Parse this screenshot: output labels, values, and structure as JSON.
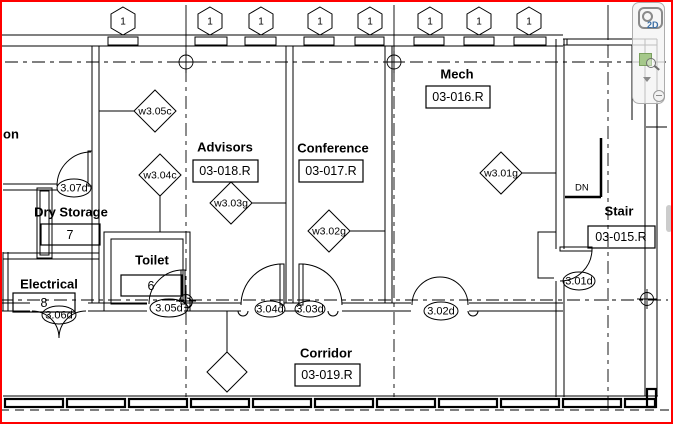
{
  "colors": {
    "selection_border": "#ff0000",
    "drawing_line": "#000000",
    "background": "#ffffff",
    "nav_2d_label_blue": "#3a6ea5",
    "nav_zoom_green": "#a5c88a",
    "nav_icon_gray": "#8a8a8a",
    "scrollbar_thumb": "#cccccc"
  },
  "grid_bubbles": [
    "1",
    "1",
    "1",
    "1",
    "1",
    "1",
    "1",
    "1"
  ],
  "rooms": {
    "partial_left": {
      "name": "on"
    },
    "dry_storage": {
      "name": "Dry Storage",
      "number": "7"
    },
    "toilet": {
      "name": "Toilet",
      "number": "6"
    },
    "electrical": {
      "name": "Electrical",
      "number": "8"
    },
    "advisors": {
      "name": "Advisors",
      "number": "03-018.R"
    },
    "conference": {
      "name": "Conference",
      "number": "03-017.R"
    },
    "mech": {
      "name": "Mech",
      "number": "03-016.R"
    },
    "stair": {
      "name": "Stair",
      "number": "03-015.R"
    },
    "corridor": {
      "name": "Corridor",
      "number": "03-019.R"
    }
  },
  "wall_tags": [
    "w3.05c",
    "w3.04c",
    "w3.03g",
    "w3.02g",
    "w3.01g"
  ],
  "door_tags": [
    "3.07d",
    "3.06d",
    "3.05d",
    "3.04d",
    "3.03d",
    "3.02d",
    "3.01d"
  ],
  "stair_annotation": {
    "direction": "DN"
  },
  "navigation_bar": {
    "wheel_mode": "2D"
  }
}
